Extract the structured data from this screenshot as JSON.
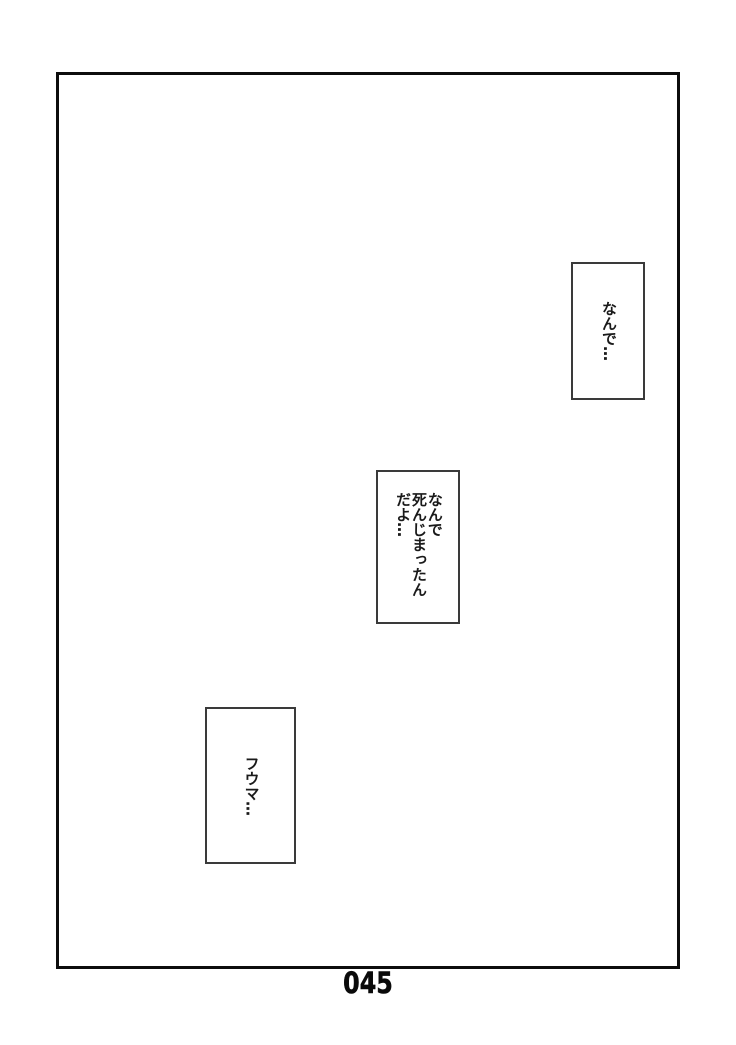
{
  "page": {
    "number": "045",
    "background_color": "#ffffff",
    "frame_border_color": "#0d0d0d",
    "text_color": "#1a1a1a"
  },
  "speech_boxes": [
    {
      "text": "なんで…"
    },
    {
      "lines": [
        "なんで",
        "死んじまったん",
        "だよ…"
      ]
    },
    {
      "text": "フウマ…"
    }
  ]
}
